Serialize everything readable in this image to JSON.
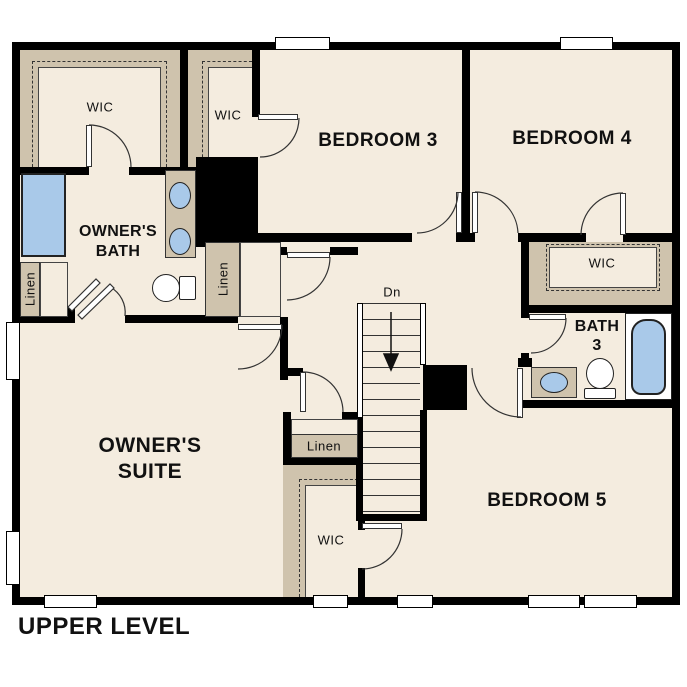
{
  "plan": {
    "title": "UPPER LEVEL",
    "stairs": {
      "direction_label": "Dn"
    },
    "rooms": {
      "owners_suite": {
        "line1": "OWNER'S",
        "line2": "SUITE"
      },
      "owners_bath": {
        "line1": "OWNER'S",
        "line2": "BATH"
      },
      "bedroom3": {
        "label": "BEDROOM 3"
      },
      "bedroom4": {
        "label": "BEDROOM 4"
      },
      "bedroom5": {
        "label": "BEDROOM 5"
      },
      "bath3": {
        "line1": "BATH",
        "line2": "3"
      },
      "wic_owners": {
        "label": "WIC"
      },
      "wic_bedroom3": {
        "label": "WIC"
      },
      "wic_bedroom4": {
        "label": "WIC"
      },
      "wic_bedroom5": {
        "label": "WIC"
      },
      "linen_bath": {
        "label": "Linen"
      },
      "linen_hall_upper": {
        "label": "Linen"
      },
      "linen_hall_lower": {
        "label": "Linen"
      }
    },
    "colors": {
      "wall": "#000000",
      "floor": "#f4ecdf",
      "closet_band": "#cfc3ad",
      "fixture_blue": "#a9c9e9"
    }
  }
}
